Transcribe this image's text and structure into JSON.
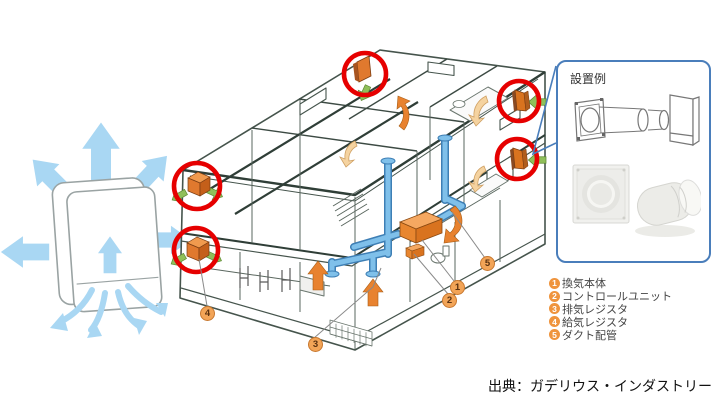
{
  "panel": {
    "title": "設置例"
  },
  "legend": {
    "items": [
      {
        "num": "1",
        "label": "換気本体"
      },
      {
        "num": "2",
        "label": "コントロールユニット"
      },
      {
        "num": "3",
        "label": "排気レジスタ"
      },
      {
        "num": "4",
        "label": "給気レジスタ"
      },
      {
        "num": "5",
        "label": "ダクト配管"
      }
    ]
  },
  "source": {
    "text": "出典：ガデリウス・インダストリー"
  },
  "colors": {
    "highlight_red": "#e60000",
    "duct_blue": "#6fb3e2",
    "airflow_blue": "#a9d7f3",
    "marker_orange": "#f2a457",
    "legend_badge_orange": "#ef943d",
    "vent_orange": "#e0792e",
    "supply_arrow_green": "#8fbf5a",
    "panel_border_blue": "#4a7ebb",
    "house_line": "#45544c"
  }
}
